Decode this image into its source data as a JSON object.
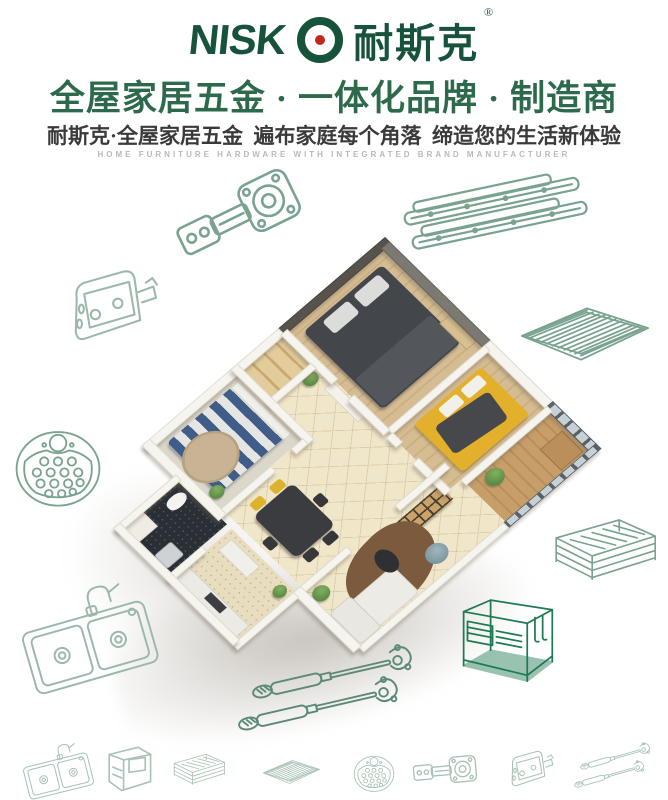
{
  "brand": {
    "logo_text": "NISK",
    "logo_o": "O",
    "logo_cjk": "耐斯克",
    "registered": "®",
    "logo_green": "#17523a",
    "logo_dot_red": "#c3281c"
  },
  "header": {
    "headline": "全屋家居五金 · 一体化品牌 · 制造商",
    "subheadline": "耐斯克·全屋家居五金  遍布家庭每个角落  缔造您的生活新体验",
    "tagline_en": "HOME FURNITURE HARDWARE WITH INTEGRATED BRAND MANUFACTURER"
  },
  "palette": {
    "headline_green": "#2d6a4b",
    "subtitle_gray": "#3a3a3a",
    "tagline_gray": "#b9b9b9",
    "icon_green_light": "#9cb8aa",
    "icon_green_dark": "#1e7a52",
    "floor_wood": "#d3b98e",
    "floor_tile": "#f0e6c9",
    "wall_white": "#f6f4ee",
    "accent_wall": "#57534c",
    "bed_dark": "#43464b",
    "bed_yellow": "#e3b02c",
    "bed_stripe_blue": "#3f5d88"
  },
  "floorplan": {
    "type": "isometric-3d-apartment-render",
    "rooms": [
      "master-bedroom",
      "second-bedroom",
      "third-bedroom",
      "living-room",
      "dining-area",
      "kitchen",
      "bathroom",
      "hallway",
      "balcony"
    ]
  },
  "hardware_icons": {
    "surrounding": [
      {
        "name": "cabinet-hinge"
      },
      {
        "name": "drawer-slides"
      },
      {
        "name": "door-bracket"
      },
      {
        "name": "wire-shelf"
      },
      {
        "name": "perforated-plate"
      },
      {
        "name": "wire-basket"
      },
      {
        "name": "kitchen-sink"
      },
      {
        "name": "gas-lift-struts"
      },
      {
        "name": "countertop-rack"
      }
    ],
    "bottom_row": [
      {
        "name": "kitchen-sink"
      },
      {
        "name": "storage-cabinet"
      },
      {
        "name": "wire-basket"
      },
      {
        "name": "wire-shelf"
      },
      {
        "name": "perforated-plate"
      },
      {
        "name": "cabinet-hinge"
      },
      {
        "name": "door-bracket"
      },
      {
        "name": "gas-lift-struts"
      }
    ]
  }
}
